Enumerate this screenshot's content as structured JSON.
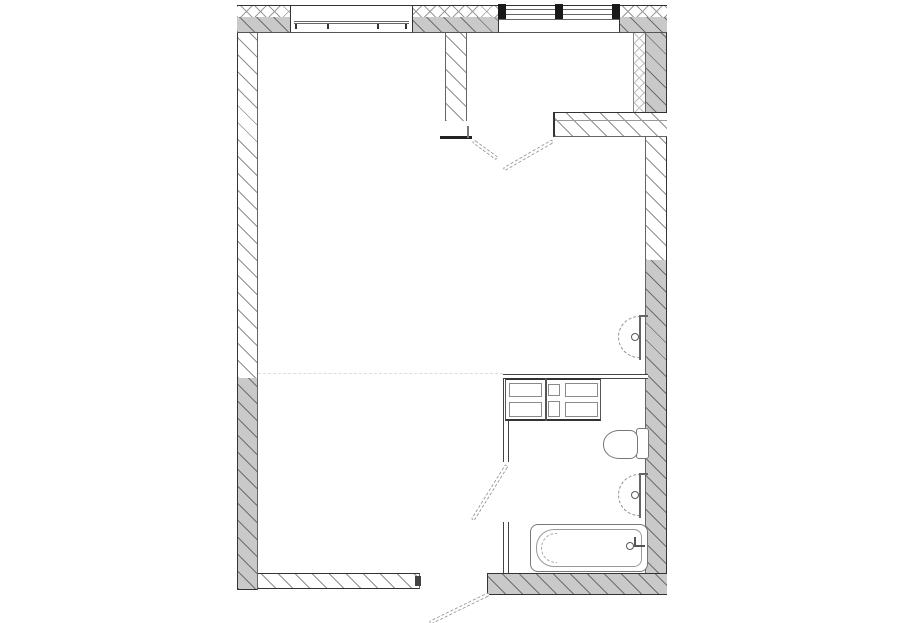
{
  "document": {
    "kind": "architectural-floor-plan",
    "title": "Studio apartment floor plan",
    "visible_text": []
  },
  "colors": {
    "background": "#ffffff",
    "wall_fill": "#c9c9c9",
    "line_dark": "#333333",
    "line_medium": "#666666",
    "fixture_line": "#8e8e8e",
    "leaf_line": "#9b9b9b",
    "faint_dash": "#dcdcdc",
    "window_post": "#1a1a1a"
  },
  "rooms": [
    {
      "name": "main-room",
      "note": "large open living space, left/center"
    },
    {
      "name": "entry-hall",
      "note": "small room top-right"
    },
    {
      "name": "bathroom-zone",
      "note": "right side with fixtures"
    }
  ],
  "openings": [
    {
      "name": "window-left",
      "symbol": "double sill line with mullion ticks"
    },
    {
      "name": "window-right",
      "symbol": "triple glazing lines with three dark posts"
    },
    {
      "name": "double-door-hall",
      "symbol": "two swinging leaves below entry hall"
    },
    {
      "name": "bathroom-door",
      "symbol": "leaf swinging into main room"
    },
    {
      "name": "entrance-door",
      "symbol": "leaf swinging outward through bottom wall"
    }
  ],
  "fixtures": [
    {
      "name": "wash-basin-upper",
      "symbol": "half-round basin on right wall with tap"
    },
    {
      "name": "kitchen-cabinets",
      "symbol": "counter block with six drawer fronts"
    },
    {
      "name": "toilet",
      "symbol": "bowl with tank against right wall"
    },
    {
      "name": "wash-basin-lower",
      "symbol": "half-round basin on right wall with tap"
    },
    {
      "name": "bathtub",
      "symbol": "rounded tub with faucet at right end"
    }
  ]
}
